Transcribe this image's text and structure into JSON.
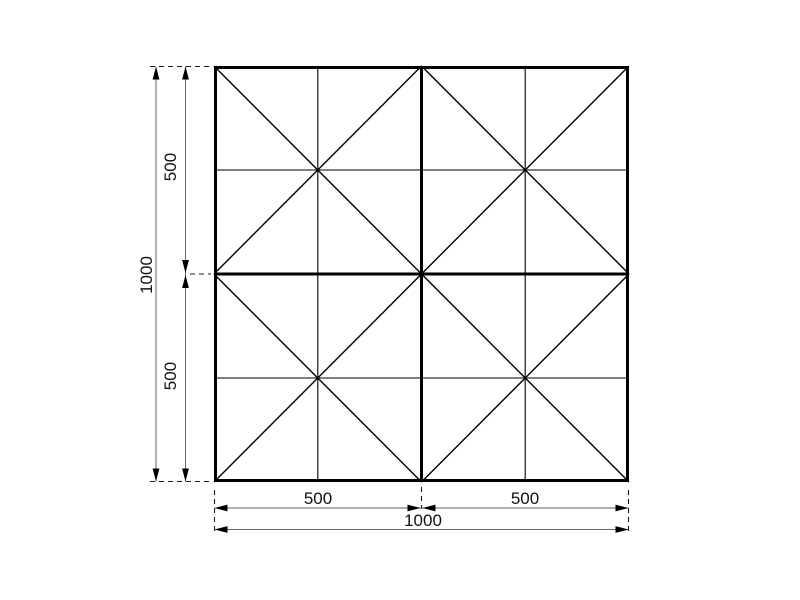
{
  "drawing": {
    "type": "technical-dimension-drawing",
    "background_color": "#ffffff",
    "line_color": "#000000",
    "dimension_line_color": "#666666",
    "structure": {
      "overall_width": 1000,
      "overall_height": 1000,
      "bay_width": 500,
      "bay_height": 500,
      "columns": 2,
      "rows": 2,
      "bay_pattern": "each 500x500 bay has corner-to-corner X diagonals plus mid vertical and mid horizontal ribs"
    },
    "dimensions": {
      "left": [
        {
          "label": "500"
        },
        {
          "label": "500"
        },
        {
          "label": "1000"
        }
      ],
      "bottom": [
        {
          "label": "500"
        },
        {
          "label": "500"
        },
        {
          "label": "1000"
        }
      ]
    }
  }
}
